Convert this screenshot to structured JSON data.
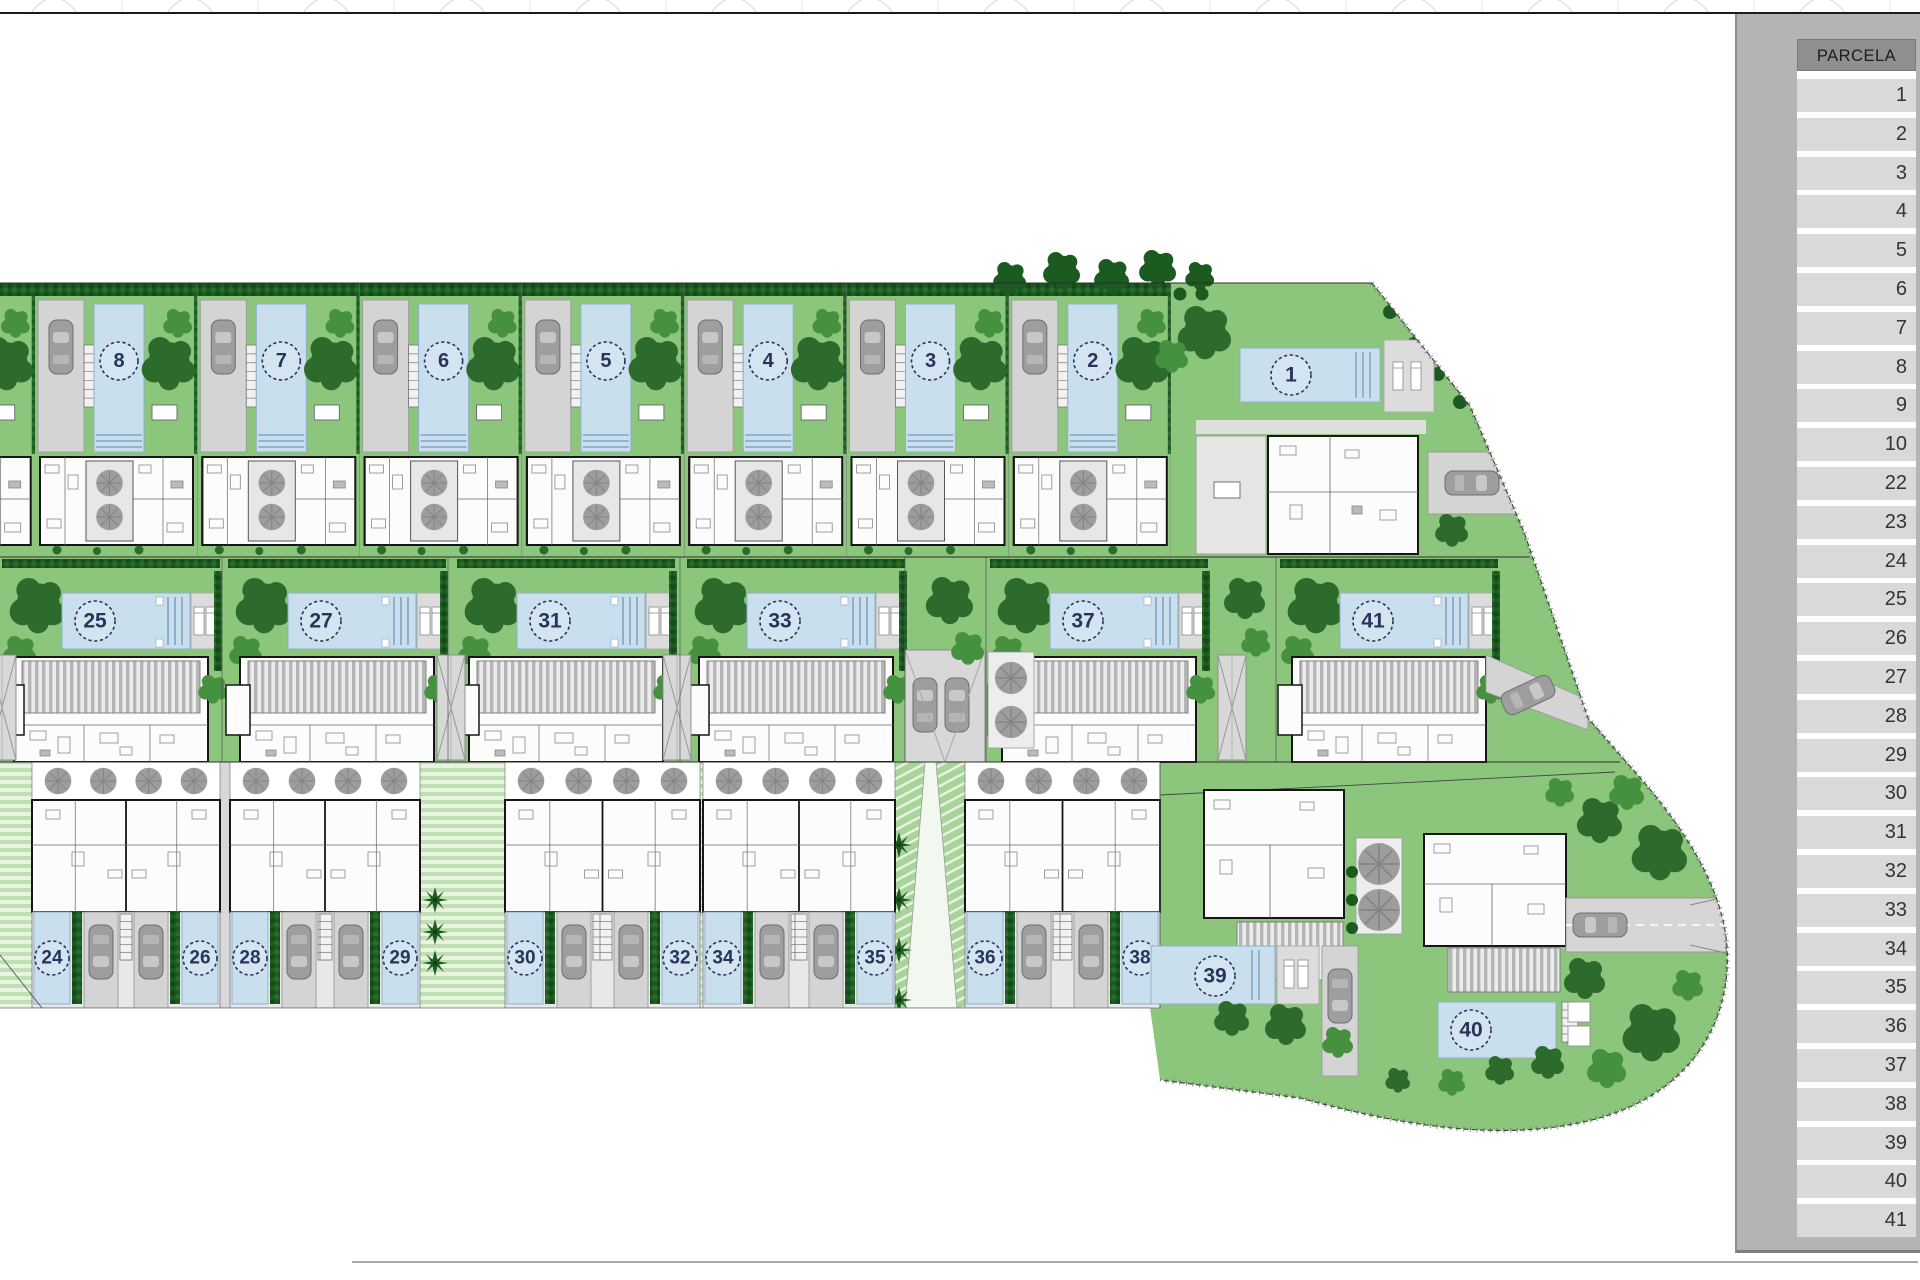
{
  "sidebar": {
    "header": "PARCELA",
    "rows": [
      "1",
      "2",
      "3",
      "4",
      "5",
      "6",
      "7",
      "8",
      "9",
      "10",
      "22",
      "23",
      "24",
      "25",
      "26",
      "27",
      "28",
      "29",
      "30",
      "31",
      "32",
      "33",
      "34",
      "35",
      "36",
      "37",
      "38",
      "39",
      "40",
      "41"
    ]
  },
  "plan": {
    "top_row": [
      "8",
      "7",
      "6",
      "5",
      "4",
      "3",
      "2"
    ],
    "top_corner": "1",
    "middle_row": [
      "25",
      "27",
      "31",
      "33",
      "37",
      "41"
    ],
    "bottom_pairs": [
      [
        "24",
        "26"
      ],
      [
        "28",
        "29"
      ],
      [
        "30",
        "32"
      ],
      [
        "34",
        "35"
      ],
      [
        "36",
        "38"
      ]
    ],
    "corner_detached": [
      "39",
      "40"
    ]
  },
  "colors": {
    "lawn": "#8cc57c",
    "lawn_light": "#a8d49a",
    "pool": "#cadfee",
    "pool_border": "#8fb0c9",
    "pool_line": "#5d87ad",
    "hedge": "#1c5b20",
    "tree_dark": "#2c6b2c",
    "tree_mid": "#45913f",
    "driveway": "#d4d4d4",
    "car": "#9e9e9e",
    "gray_tree": "#9d9d9d",
    "house_wall": "#161616",
    "panel": "#b4b4b4",
    "panel_header": "#8f8f8f",
    "cell": "#d9d9d9",
    "number": "#24365c"
  }
}
